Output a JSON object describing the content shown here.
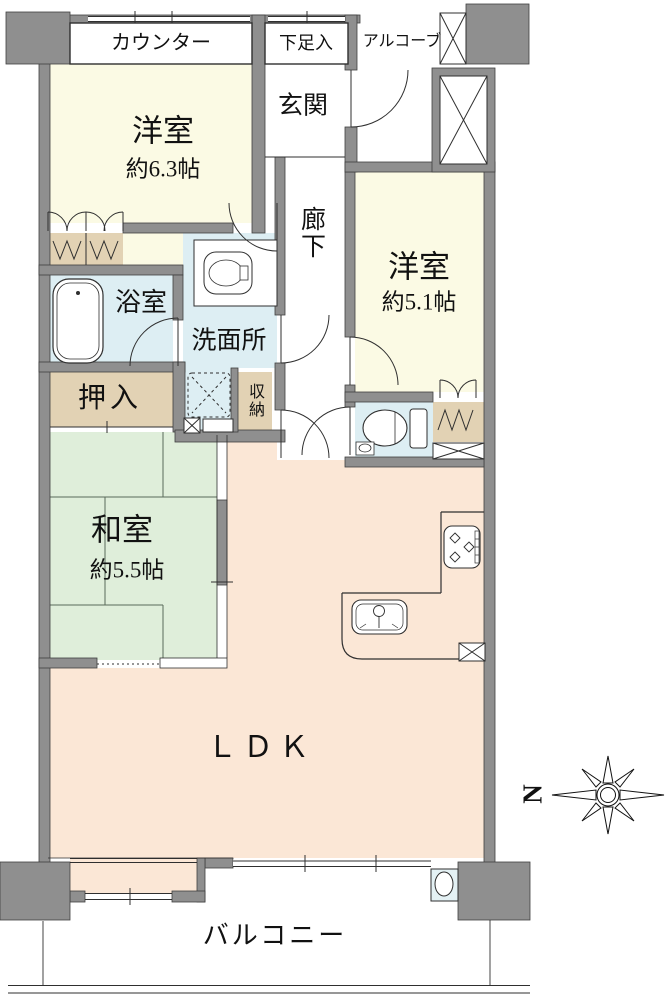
{
  "labels": {
    "counter": "カウンター",
    "shoe_storage": "下足入",
    "alcove": "アルコーブ",
    "entrance": "玄関",
    "corridor": "廊下",
    "western_room_large": {
      "name": "洋室",
      "area": "約6.3帖"
    },
    "western_room_small": {
      "name": "洋室",
      "area": "約5.1帖"
    },
    "bathroom": "浴室",
    "washroom": "洗面所",
    "futon_closet": "押入",
    "storage": "収納",
    "japanese_room": {
      "name": "和室",
      "area": "約5.5帖"
    },
    "living": "ＬＤＫ",
    "balcony": "バルコニー",
    "compass_north": "N"
  },
  "colors": {
    "wall": "#8f8f8f",
    "wall_edge": "#3f3f3f",
    "western_room": "#fbfae4",
    "wet_area": "#ddeef3",
    "closet": "#e2d2b4",
    "japanese_room": "#dfeeda",
    "ldk": "#fbe7d6",
    "line": "#2f2f2f"
  },
  "icons": [
    "bathtub-icon",
    "washbasin-icon",
    "washing-machine-icon",
    "toilet-icon",
    "stove-icon",
    "kitchen-sink-icon",
    "slop-sink-icon",
    "compass-rose-icon",
    "hanger-rod-icon",
    "pillar-cross-icon"
  ]
}
